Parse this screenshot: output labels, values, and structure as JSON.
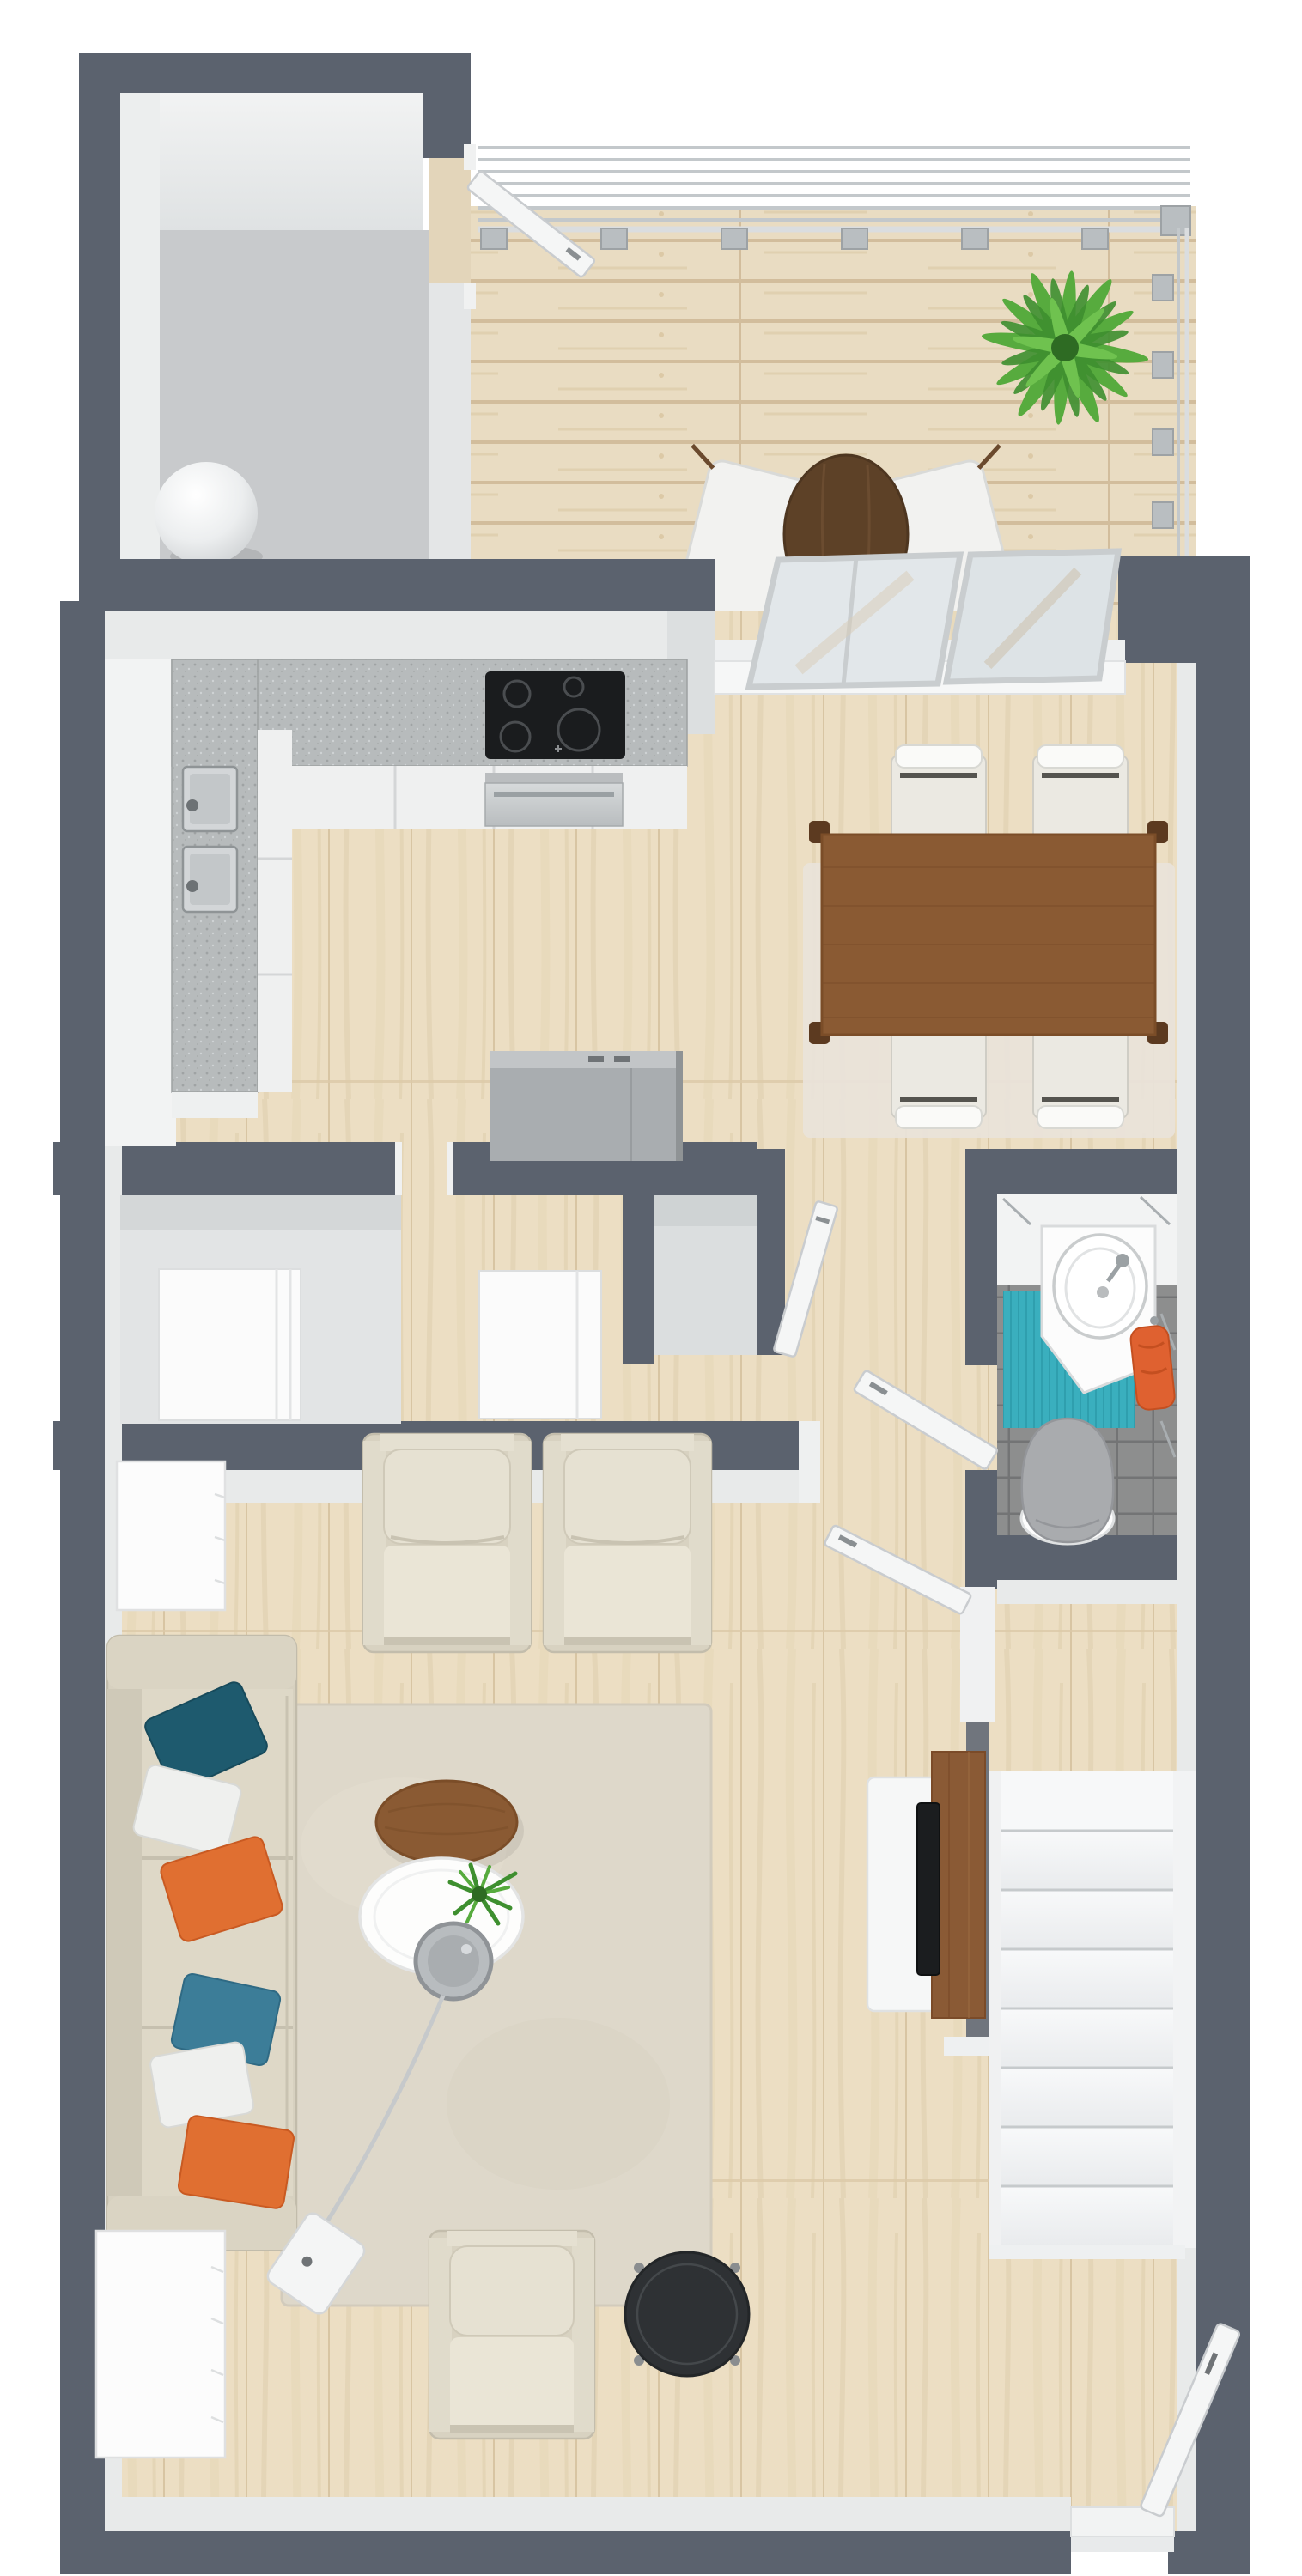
{
  "meta": {
    "view": "top-down 3D render",
    "scene": "apartment floor plan with terrace, kitchen, dining room, hallway closets, bathroom, living room, staircase and entry"
  },
  "colors": {
    "wall": "#5b626e",
    "wallFace": "#e8eaea",
    "wood": "#ecdec3",
    "woodSeam": "#d8c5a3",
    "deck": "#e9dcc2",
    "deckSeam": "#d2bd9c",
    "storageFloor": "#c8cacc",
    "counter": "#b7bbbc",
    "cabinet": "#f2f3f3",
    "cooktop": "#1a1c1e",
    "steel": "#c6c9cb",
    "island": "#a9adb0",
    "diningTable": "#8a5a33",
    "tableLeg": "#5c3a20",
    "chair": "#ebe9e2",
    "rugDining": "#e9e3da",
    "rugLiving": "#ded8ca",
    "tile": "#8d8e8e",
    "tealMat": "#3aafbe",
    "towel": "#df6130",
    "toilet": "#a9abae",
    "sofa": "#d7d1c0",
    "cushion": "#e6e1d2",
    "pillowTeal": "#1e5a6e",
    "pillowBlue": "#3c7d98",
    "pillowOrange": "#e06f31",
    "pillowWhite": "#eff0ee",
    "stair": "#f6f7f8",
    "stairEdge": "#c6cacc",
    "tv": "#1b1d1f",
    "tvPanel": "#8a5a35",
    "divider": "#70757d",
    "glass": "#e2e7ea",
    "glassFrame": "#c9cdcf",
    "doorWhite": "#f5f6f6",
    "plant": "#57ab3e",
    "plantDark": "#3e8f2f",
    "lampMetal": "#c6c9cb",
    "sideTableBlack": "#2e3134"
  },
  "rooms": [
    {
      "name": "storage-room",
      "items": [
        "sphere floor lamp",
        "door to terrace"
      ]
    },
    {
      "name": "terrace",
      "items": [
        "metal railing",
        "plank decking",
        "round bistro table",
        "2 folding chairs",
        "palm plant"
      ]
    },
    {
      "name": "kitchen",
      "items": [
        "L-shaped counter",
        "double sink",
        "4-zone cooktop",
        "oven",
        "freestanding gray cabinet"
      ]
    },
    {
      "name": "dining-room",
      "items": [
        "sliding glass door",
        "wooden dining table",
        "4 upholstered chairs",
        "area rug"
      ]
    },
    {
      "name": "hallway",
      "items": [
        "closet with white cabinet",
        "closet with white dresser",
        "open closet",
        "closet door",
        "bathroom door",
        "living room door"
      ]
    },
    {
      "name": "bathroom",
      "items": [
        "corner washbasin",
        "toilet",
        "teal bath mat",
        "orange towel",
        "gray floor tiles"
      ]
    },
    {
      "name": "living-room",
      "items": [
        "sideboard",
        "3-seat sofa",
        "6 throw pillows",
        "2 armchairs",
        "round wooden coffee table",
        "round white coffee table",
        "table plant",
        "arc floor lamp",
        "dresser",
        "lounge chair",
        "black side table",
        "TV console",
        "wall-mounted TV",
        "area rug"
      ]
    },
    {
      "name": "staircase",
      "items": [
        "landing",
        "8 steps"
      ]
    },
    {
      "name": "entry",
      "items": [
        "entrance door",
        "threshold"
      ]
    }
  ]
}
